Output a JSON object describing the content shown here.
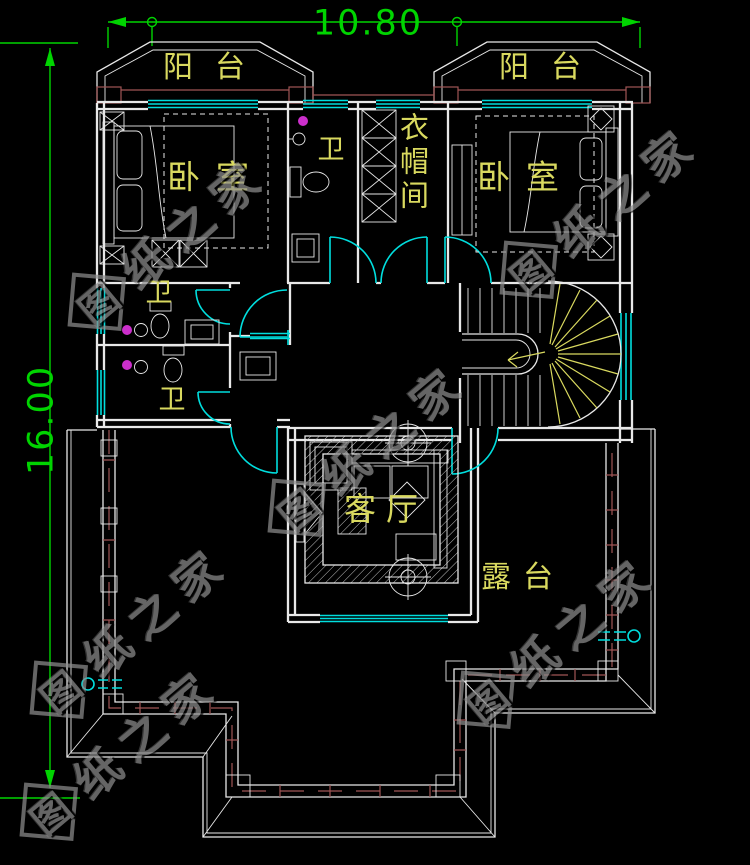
{
  "drawing_type": "floor-plan",
  "dimensions": {
    "width": "10.80",
    "height": "16.00"
  },
  "rooms": {
    "balcony": "阳台",
    "bedroom": "卧室",
    "bath": "卫",
    "cloakroom": "衣帽间",
    "living_room": "客厅",
    "terrace": "露台"
  },
  "watermark": {
    "text": "图纸之家",
    "char0": "图",
    "rest": "纸之家"
  },
  "colors": {
    "line": "#e8e8e8",
    "window": "#00dede",
    "label": "#d9d95f",
    "dimension": "#00d400",
    "accent": "#a05555",
    "light": "#cc2fcc",
    "watermark": "#8d8d8d",
    "bg": "#000000"
  }
}
